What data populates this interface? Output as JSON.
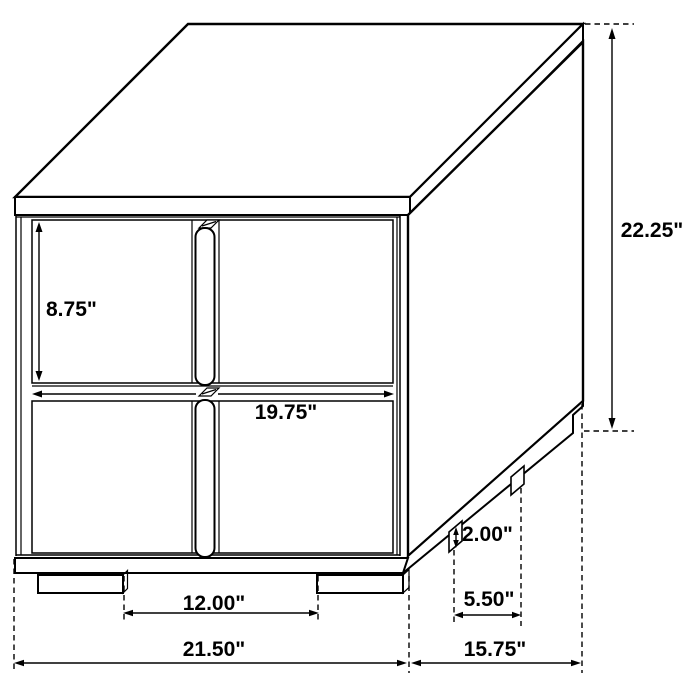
{
  "diagram": {
    "type": "furniture-dimension-drawing",
    "subject": "two-drawer-nightstand-isometric-view",
    "colors": {
      "background": "#ffffff",
      "line": "#000000",
      "text": "#000000"
    },
    "dimensions": {
      "overall_height": "22.25\"",
      "top_drawer_height": "8.75\"",
      "drawer_front_width": "19.75\"",
      "leg_height": "2.00\"",
      "side_leg_spacing": "5.50\"",
      "front_leg_spacing": "12.00\"",
      "overall_width": "21.50\"",
      "overall_depth": "15.75\""
    }
  }
}
